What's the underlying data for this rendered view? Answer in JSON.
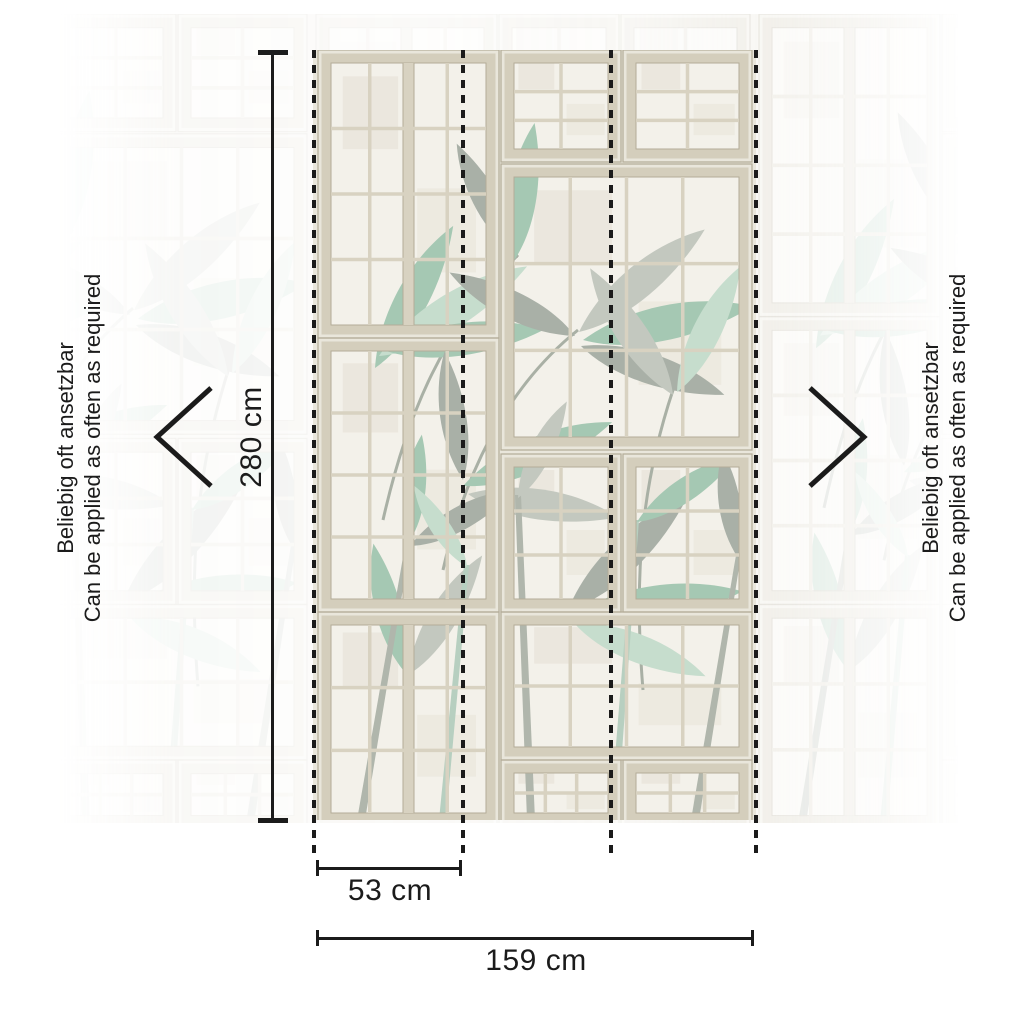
{
  "diagram": {
    "height": {
      "label": "280 cm"
    },
    "panel_width": {
      "label": "53 cm"
    },
    "total_width": {
      "label": "159 cm"
    },
    "panel_count": 3,
    "side_note": {
      "de": "Beliebig oft ansetzbar",
      "en": "Can be applied as often as required"
    },
    "icons": {
      "left": "chevron-left-icon",
      "right": "chevron-right-icon"
    }
  },
  "colors": {
    "ink": "#1b1b1b",
    "frame": "#d4cebc",
    "frame_edge": "#b3ac98",
    "grid": "#d8d2c1",
    "wall": "#e9e6db",
    "pane": "#f3f1ea",
    "leaf_sage": "#a5c8b3",
    "leaf_mint": "#c6ddcd",
    "leaf_gray": "#a9b0a7",
    "leaf_gray2": "#c3c8bf",
    "stem": "#a9b0a5",
    "bamboo_gray": "#b0b6ac",
    "bamboo_sage": "#b7cfc0"
  }
}
